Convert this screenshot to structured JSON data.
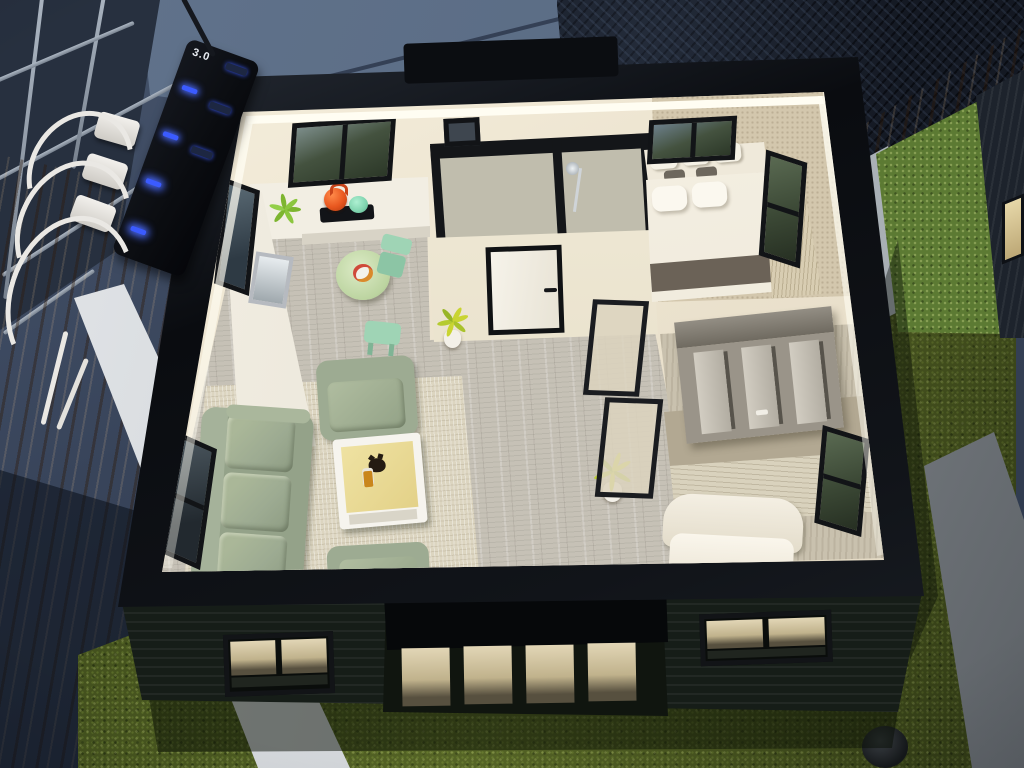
{
  "meta": {
    "description": "Photograph of an illuminated architectural scale model of a one-storey house, top removed to show the furnished floor plan, displayed on a wooden table with artificial grass base",
    "view": "high-angle interior view",
    "lighting": "warm LED strip around the open roof rim"
  },
  "power_strip": {
    "label": "3.0",
    "type": "usb-charging-strip",
    "body_color": "#0b0d11",
    "led_color": "#3b5bff",
    "plug_count": 3,
    "plug_color": "#eae8e4"
  },
  "background": {
    "wall_color": "#354154",
    "tarp_color": "#5e7089",
    "objects": [
      "metal-wire-rack",
      "dark-rattan-chair",
      "wooden-table",
      "second-house-model"
    ]
  },
  "house_model": {
    "rim_color": "#0c0e12",
    "roof_handle": true,
    "led_strip": true,
    "wall_color": "#ece3cf",
    "floor_color": "#c6c1b6",
    "exterior": {
      "siding_color": "#161d18",
      "front_windows": 2,
      "patio_door_panes": 4,
      "lit_pane_color": "#e2d6b6"
    },
    "rooms": [
      {
        "name": "kitchen",
        "features": [
          "u-shaped-white-counter",
          "sink",
          "stove",
          "orange-kettle",
          "mint-pot",
          "green-plant",
          "window-top",
          "window-left"
        ]
      },
      {
        "name": "dining",
        "features": [
          "round-green-table",
          "food-plate",
          "mint-chair",
          "mint-stool"
        ]
      },
      {
        "name": "living-room",
        "features": [
          "sage-sofa-3-seat",
          "sage-armchair-top",
          "sage-armchair-bottom",
          "white-coffee-table",
          "cat-figurine",
          "amber-bottle",
          "beige-rug",
          "window-left"
        ]
      },
      {
        "name": "bathroom",
        "features": [
          "black-framed-glass-shower",
          "shower-head",
          "small-window"
        ]
      },
      {
        "name": "hallway",
        "features": [
          "white-door-black-frame",
          "door-handle",
          "potted-plant-1",
          "potted-plant-2",
          "dark-framed-wall-panels"
        ]
      },
      {
        "name": "bedroom",
        "features": [
          "double-bed-white-duvet",
          "two-pillows",
          "headboard-cushions",
          "dark-foot-blanket",
          "side-carpet",
          "window-top",
          "window-right"
        ]
      },
      {
        "name": "wardrobe-nook",
        "features": [
          "grey-slatted-wardrobe"
        ]
      },
      {
        "name": "lounge-room",
        "features": [
          "white-curved-daybed",
          "textured-carpet",
          "window-right"
        ]
      }
    ],
    "accent_colors": {
      "sofa_sage": "#9dab92",
      "mint": "#9fd4b5",
      "kettle_orange": "#e8571f",
      "table_green": "#cbe0b4",
      "coffee_table_top": "#e8d98f"
    }
  },
  "base": {
    "grass_color": "#47551f",
    "white_board_color": "#d9dcdf",
    "grey_plank_color": "#9aa0a5",
    "sprinkler": true
  },
  "second_model": {
    "grass_color": "#5c7a33",
    "wall_color": "#1d232c",
    "lit_window_color": "#d8c493",
    "border_board_color": "#bcc3c8"
  }
}
